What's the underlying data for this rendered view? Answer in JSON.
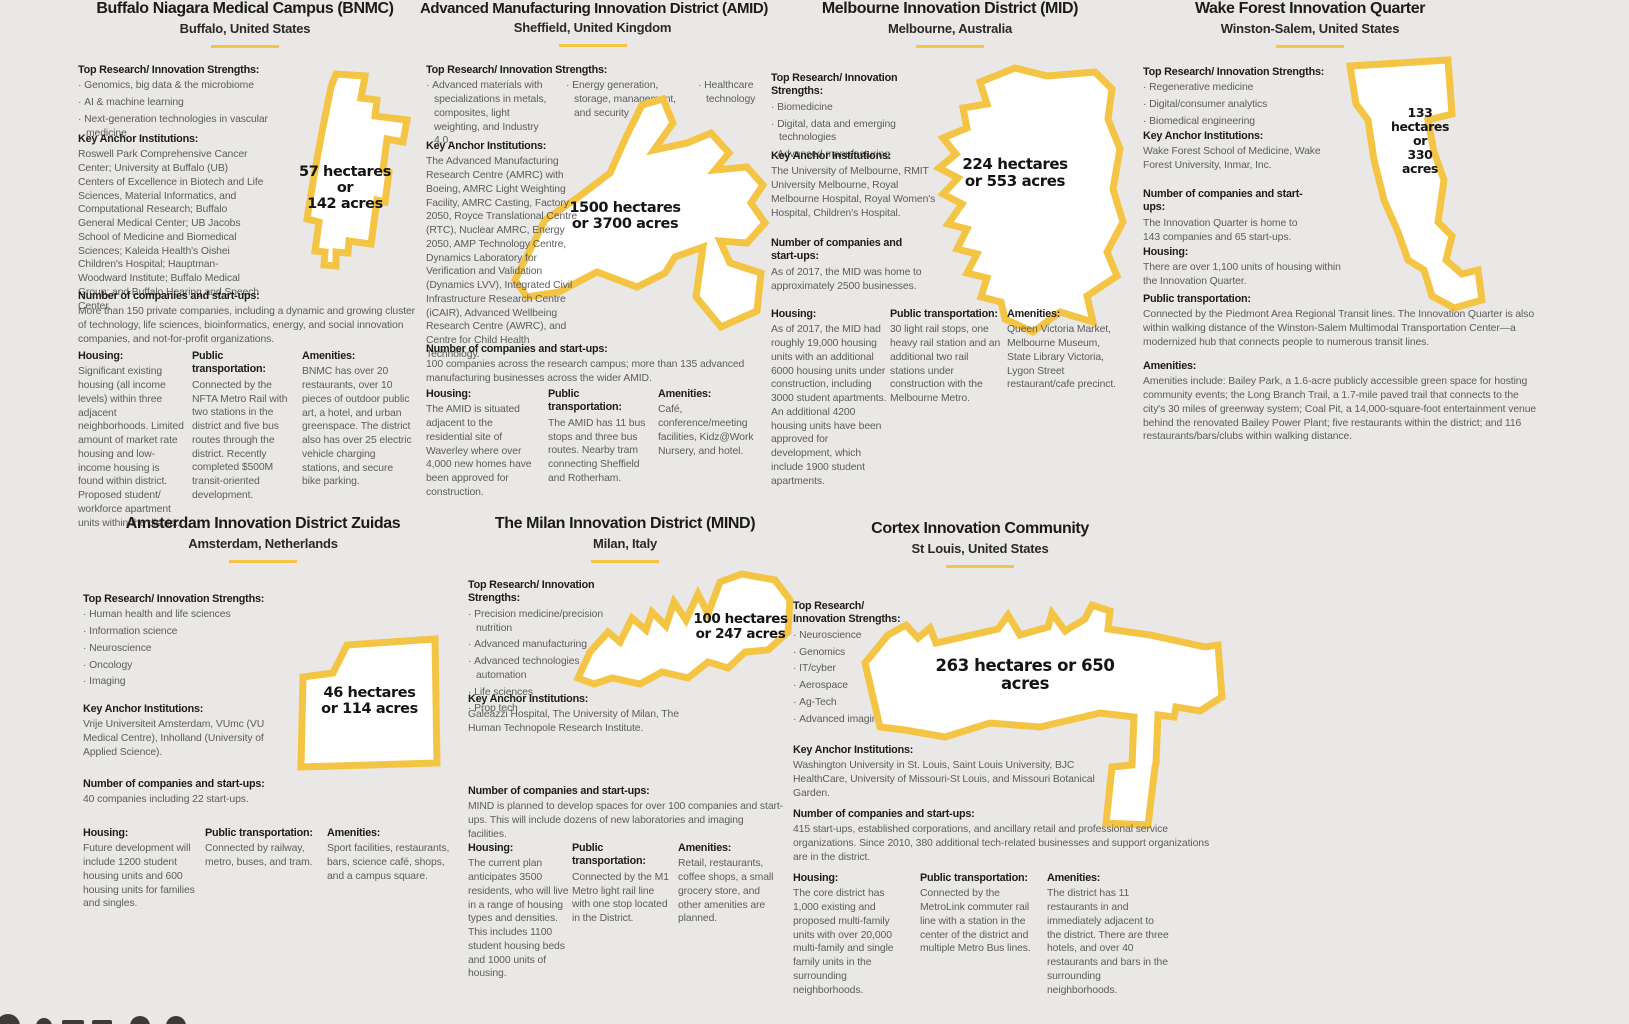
{
  "page": {
    "background": "#e9e8e6",
    "accent_yellow": "#f4c444",
    "heading_color": "#1c1b1a",
    "body_color": "#5d5d5c"
  },
  "section_labels": {
    "strengths": "Top Research/ Innovation Strengths:",
    "anchors": "Key Anchor Institutions:",
    "companies": "Number of companies and start-ups:",
    "housing": "Housing:",
    "transport": "Public transportation:",
    "amenities": "Amenities:"
  },
  "districts": [
    {
      "title": "Buffalo Niagara Medical Campus (BNMC)",
      "location": "Buffalo, United States",
      "area_lines": [
        "57 hectares",
        "or",
        "142 acres"
      ],
      "strengths": [
        "Genomics, big data & the microbiome",
        "AI & machine learning",
        "Next-generation technologies in vascular medicine"
      ],
      "anchors": "Roswell Park Comprehensive Cancer Center; University at Buffalo (UB) Centers of Excellence in Biotech and Life Sciences, Material Informatics, and Computational Research; Buffalo General Medical Center; UB Jacobs School of Medicine and Biomedical Sciences; Kaleida Health's Oishei Children's Hospital; Hauptman-Woodward Institute; Buffalo Medical Group; and Buffalo Hearing and Speech Center.",
      "companies": "More than 150 private companies, including a dynamic and growing cluster of technology, life sciences, bioinformatics, energy, and social innovation companies, and not-for-profit organizations.",
      "housing": "Significant existing housing (all income levels) within three adjacent neighborhoods. Limited amount of market rate housing and low-income housing is found within district. Proposed student/ workforce apartment units within the district.",
      "transport": "Connected by the NFTA Metro Rail with two stations in the district and five bus routes through the district. Recently completed $500M transit-oriented development.",
      "amenities": "BNMC has over 20 restaurants, over 10 pieces of outdoor public art, a hotel, and urban greenspace. The district also has over 25 electric vehicle charging stations, and secure bike parking."
    },
    {
      "title": "Advanced Manufacturing Innovation District (AMID)",
      "location": "Sheffield, United Kingdom",
      "area_lines": [
        "1500 hectares",
        "or 3700 acres"
      ],
      "strengths": [
        "Advanced materials with specializations in metals, composites, light weighting, and Industry 4.0.",
        "Energy generation, storage, management, and security",
        "Healthcare technology"
      ],
      "anchors": "The Advanced Manufacturing Research Centre (AMRC) with Boeing, AMRC Light Weighting Facility, AMRC Casting, Factory 2050, Royce Translational Centre (RTC), Nuclear AMRC, Energy 2050, AMP Technology Centre, Dynamics Laboratory for Verification and Validation (Dynamics LVV), Integrated Civil Infrastructure Research Centre (iCAIR), Advanced Wellbeing Research Centre (AWRC), and Centre for Child Health Technology.",
      "companies": "100 companies across the research campus; more than 135 advanced manufacturing businesses across the wider AMID.",
      "housing": "The AMID is situated adjacent to the residential site of Waverley where over 4,000 new homes have been approved for construction.",
      "transport": "The AMID has 11 bus stops and three bus routes. Nearby tram connecting Sheffield and Rotherham.",
      "amenities": "Café, conference/meeting facilities, Kidz@Work Nursery, and hotel."
    },
    {
      "title": "Melbourne Innovation District (MID)",
      "location": "Melbourne, Australia",
      "area_lines": [
        "224 hectares",
        "or 553 acres"
      ],
      "strengths": [
        "Biomedicine",
        "Digital, data and emerging technologies",
        "Advanced manufacturing"
      ],
      "anchors": "The University of Melbourne, RMIT University Melbourne, Royal Melbourne Hospital, Royal Women's Hospital, Children's Hospital.",
      "companies": "As of 2017, the MID was home to approximately 2500 businesses.",
      "housing": "As of 2017, the MID had roughly 19,000 housing units with an additional 6000 housing units under construction, including 3000 student apartments. An additional 4200 housing units have been approved for development, which include 1900 student apartments.",
      "transport": "30 light rail stops, one heavy rail station and an additional two rail stations under construction with the Melbourne Metro.",
      "amenities": "Queen Victoria Market, Melbourne Museum, State Library Victoria, Lygon Street restaurant/cafe precinct."
    },
    {
      "title": "Wake Forest Innovation Quarter",
      "location": "Winston-Salem, United States",
      "area_lines": [
        "133",
        "hectares",
        "or",
        "330",
        "acres"
      ],
      "strengths": [
        "Regenerative medicine",
        "Digital/consumer analytics",
        "Biomedical engineering"
      ],
      "anchors": "Wake Forest School of Medicine, Wake Forest University, Inmar, Inc.",
      "companies": "The Innovation Quarter is home to 143 companies and 65 start-ups.",
      "housing": "There are over 1,100 units of housing within the Innovation Quarter.",
      "transport": "Connected by the Piedmont Area Regional Transit lines. The Innovation Quarter is also within walking distance of the Winston-Salem Multimodal Transportation Center—a modernized hub that connects people to numerous transit lines.",
      "amenities": "Amenities include: Bailey Park, a 1.6-acre publicly accessible green space for hosting community events; the Long Branch Trail, a 1.7-mile paved trail that connects to the city's 30 miles of greenway system; Coal Pit, a 14,000-square-foot entertainment venue behind the renovated Bailey Power Plant; five restaurants within the district; and 116 restaurants/bars/clubs within walking distance."
    },
    {
      "title": "Amsterdam Innovation District Zuidas",
      "location": "Amsterdam, Netherlands",
      "area_lines": [
        "46 hectares",
        "or 114 acres"
      ],
      "strengths": [
        "Human health and life sciences",
        "Information science",
        "Neuroscience",
        "Oncology",
        "Imaging"
      ],
      "anchors": "Vrije Universiteit Amsterdam, VUmc (VU Medical Centre), Inholland (University of Applied Science).",
      "companies": "40 companies including 22 start-ups.",
      "housing": "Future development will include 1200 student housing units and 600 housing units for families and singles.",
      "transport": "Connected by railway, metro, buses, and tram.",
      "amenities": "Sport facilities, restaurants, bars, science café, shops, and a campus square."
    },
    {
      "title": "The Milan Innovation District (MIND)",
      "location": "Milan, Italy",
      "area_lines": [
        "100 hectares",
        "or 247 acres"
      ],
      "strengths": [
        "Precision medicine/precision nutrition",
        "Advanced manufacturing",
        "Advanced technologies and automation",
        "Life sciences",
        "Prop tech"
      ],
      "anchors": "Galeazzi Hospital, The University of Milan, The Human Technopole Research Institute.",
      "companies": "MIND is planned to develop spaces for over 100 companies and start-ups. This will include dozens of new laboratories and imaging facilities.",
      "housing": "The current plan anticipates 3500 residents, who will live in a range of housing types and densities. This includes 1100 student housing beds and 1000 units of housing.",
      "transport": "Connected by the M1 Metro light rail line with one stop located in the District.",
      "amenities": "Retail, restaurants, coffee shops, a small grocery store, and other amenities are planned."
    },
    {
      "title": "Cortex Innovation Community",
      "location": "St Louis, United States",
      "area_lines": [
        "263 hectares or 650 acres"
      ],
      "strengths": [
        "Neuroscience",
        "Genomics",
        "IT/cyber",
        "Aerospace",
        "Ag-Tech",
        "Advanced imaging"
      ],
      "anchors": "Washington University in St. Louis, Saint Louis University, BJC HealthCare, University of Missouri-St Louis, and Missouri Botanical Garden.",
      "companies": "415 start-ups, established corporations, and ancillary retail and professional service organizations. Since 2010, 380 additional tech-related businesses and support organizations are in the district.",
      "housing": "The core district has 1,000 existing and proposed multi-family units with over 20,000 multi-family and single family units in the surrounding neighborhoods.",
      "transport": "Connected by the MetroLink commuter rail line with a station in the center of the district and multiple Metro Bus lines.",
      "amenities": "The district has 11 restaurants in and immediately adjacent to the district. There are three hotels, and over 40 restaurants and bars in the surrounding neighborhoods."
    }
  ]
}
